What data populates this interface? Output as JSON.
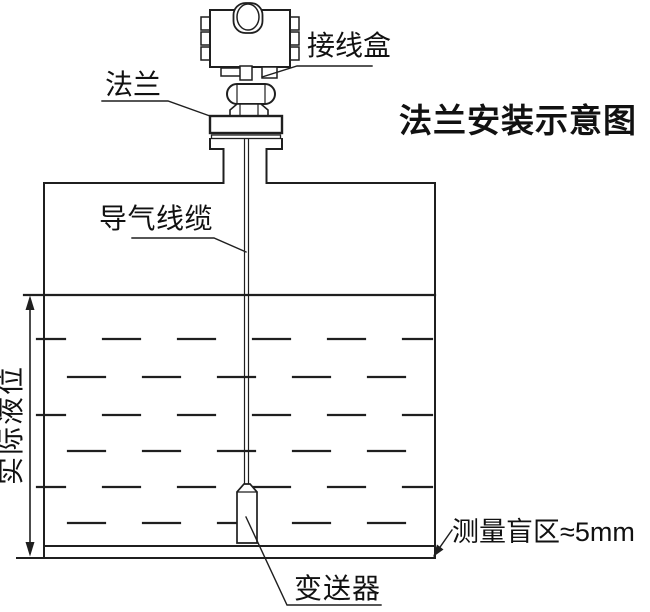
{
  "title": "法兰安装示意图",
  "labels": {
    "junction_box": "接线盒",
    "flange": "法兰",
    "air_guide_cable": "导气线缆",
    "actual_liquid_level": "实际液位",
    "blind_zone": "测量盲区≈5mm",
    "transmitter": "变送器"
  },
  "colors": {
    "line": "#1f1f1f",
    "text": "#111111",
    "background": "#ffffff"
  }
}
